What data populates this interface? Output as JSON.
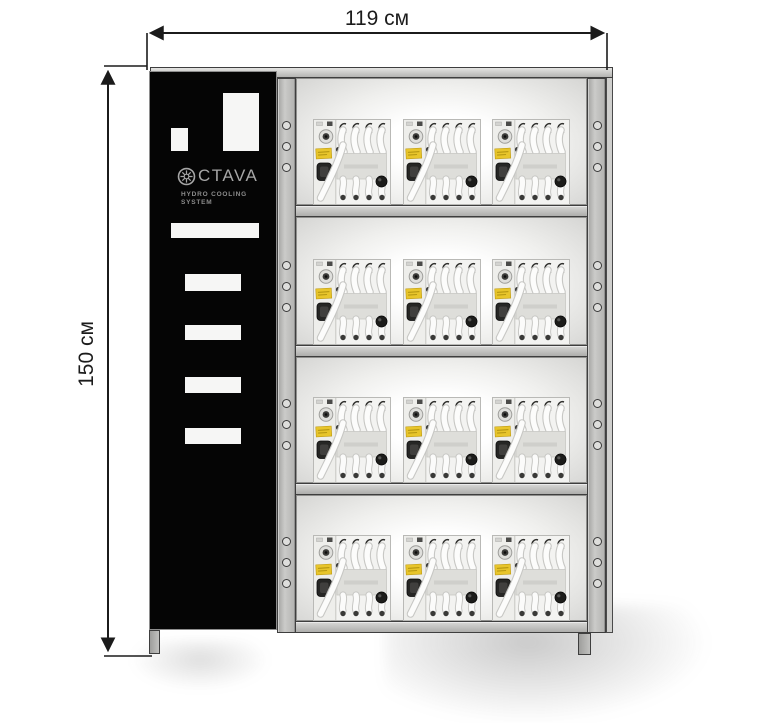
{
  "dimensions": {
    "width_label": "119 см",
    "height_label": "150 см"
  },
  "panel": {
    "brand_icon": "gear-icon",
    "brand_text": "CTAVA",
    "subtitle_line1": "HYDRO COOLING",
    "subtitle_line2": "SYSTEM"
  },
  "rack": {
    "shelf_count": 4,
    "devices_per_shelf": 3,
    "device_name": "hydro-cooling-module"
  },
  "colors": {
    "frame_gray": "#c2c2c0",
    "frame_border": "#3e3e3e",
    "panel_black": "#050505",
    "cutout_white": "#f6f6f5",
    "logo_gray": "#a6a6a6",
    "label_yellow": "#e8c52b",
    "dimension_ink": "#1b1b1b"
  }
}
